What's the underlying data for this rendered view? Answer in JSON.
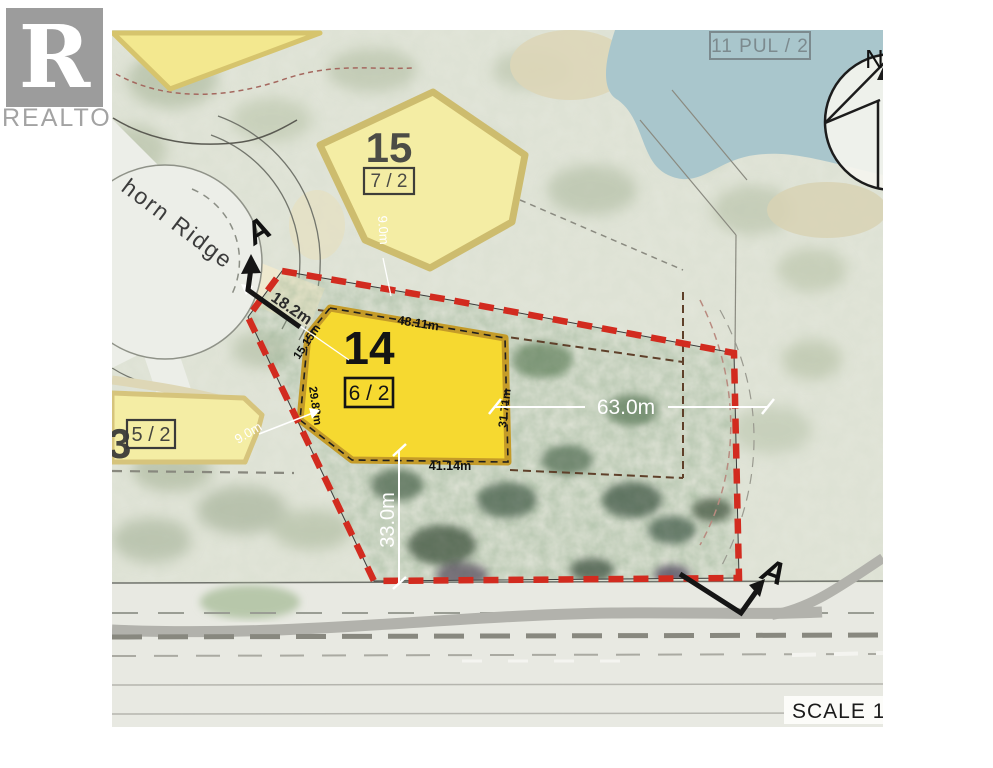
{
  "logo": {
    "letter": "R",
    "word": "REALTOR",
    "reg": "®"
  },
  "street": {
    "label": "horn Ridge"
  },
  "water": {
    "label": "11 PUL / 2"
  },
  "compass": {
    "north_label": "N"
  },
  "scale": {
    "label": "SCALE 1"
  },
  "section_markers": {
    "top_label": "A",
    "bottom_label": "A"
  },
  "lots": {
    "lot15": {
      "number": "15",
      "plan": "7 / 2"
    },
    "lot14": {
      "number": "14",
      "plan": "6 / 2"
    },
    "lot13": {
      "number": "3",
      "plan": "5 / 2"
    }
  },
  "dimensions": {
    "road_frontage": "18.2m",
    "ne_side": "15.15m",
    "top_side": "48.11m",
    "west_side": "29.83m",
    "east_side": "31.71m",
    "bottom_side": "41.14m",
    "depth": "63.0m",
    "south_depth": "33.0m",
    "offset_a": "9.0m",
    "offset_b": "9.0m"
  },
  "colors": {
    "boundary_red": "#d22b1f",
    "lot14_fill": "#f6d930",
    "lot15_fill": "#f4eda4",
    "water_fill": "#a9c6cc",
    "logo_gray": "#9c9c9c"
  }
}
